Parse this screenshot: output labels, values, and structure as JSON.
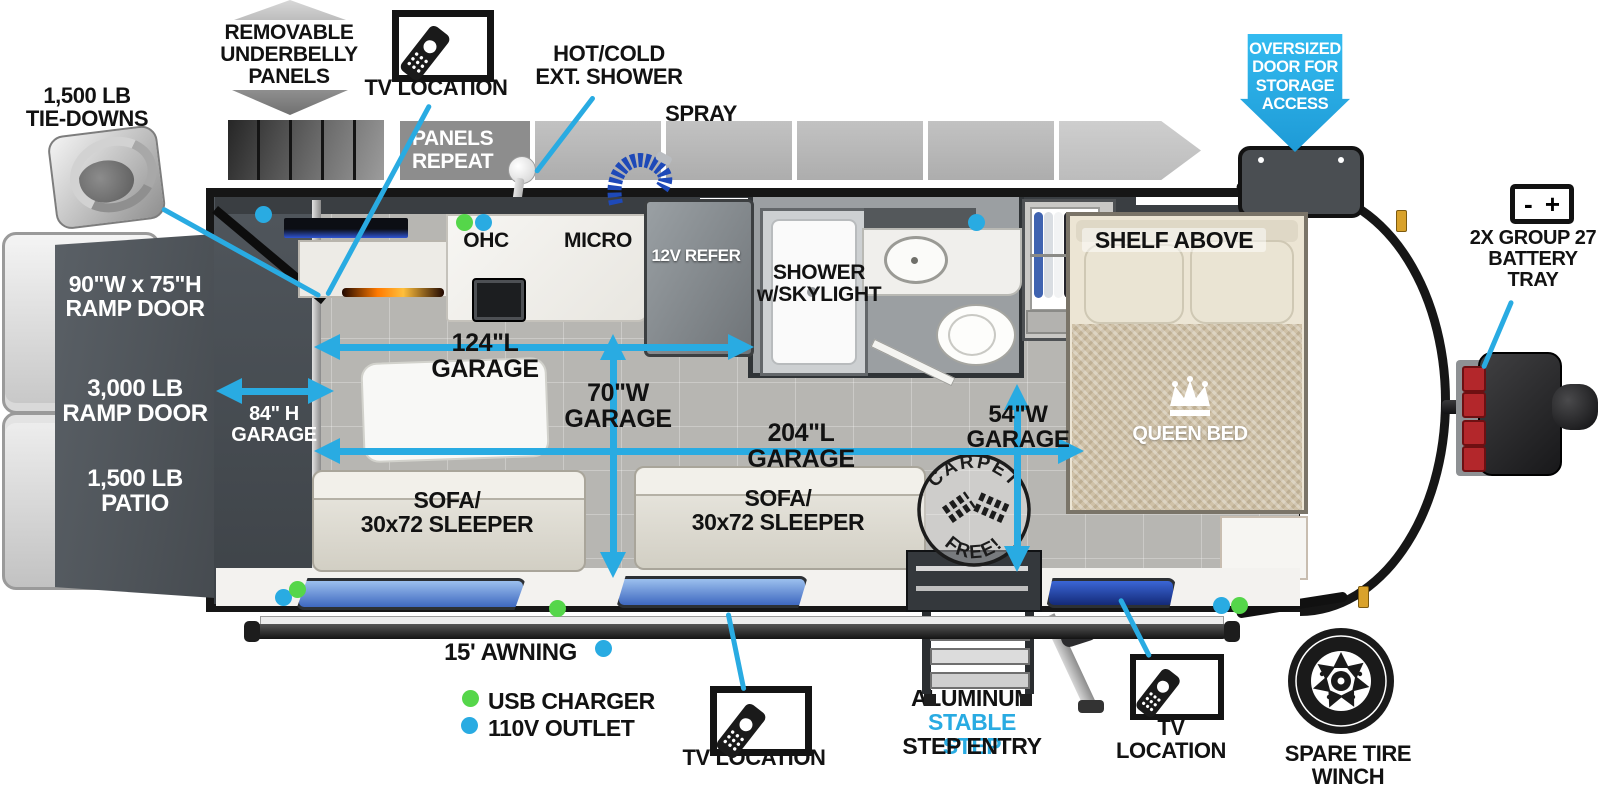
{
  "colors": {
    "accent_blue": "#29abe2",
    "usb_green": "#55d64a",
    "outlet_blue": "#29abe2",
    "panel_gray": "#8d8d8d"
  },
  "callouts": {
    "tie_downs": "1,500 LB\nTIE-DOWNS",
    "underbelly": "REMOVABLE\nUNDERBELLY\nPANELS",
    "tv_top": "TV LOCATION",
    "ext_shower": "HOT/COLD\nEXT. SHOWER",
    "spray_port": "SPRAY\nPORT",
    "panels_repeat": "PANELS\nREPEAT",
    "oversized_door": "OVERSIZED\nDOOR FOR\nSTORAGE\nACCESS",
    "battery_tray": "2X GROUP 27\nBATTERY\nTRAY",
    "battery_minus": "-",
    "battery_plus": "+",
    "awning": "15' AWNING",
    "tv_bottom": "TV LOCATION",
    "step_entry_1": "ALUMINUM",
    "step_entry_2": "STABLE STEP",
    "step_entry_3": "STEP ENTRY",
    "tv_front": "TV LOCATION",
    "spare_tire": "SPARE TIRE\nWINCH SYSTEM"
  },
  "legend": {
    "usb": "USB CHARGER",
    "outlet": "110V OUTLET"
  },
  "ramp": {
    "size": "90\"W x 75\"H\nRAMP DOOR",
    "capacity": "3,000 LB\nRAMP DOOR",
    "patio": "1,500 LB\nPATIO"
  },
  "garage": {
    "height_84": "84\" H\nGARAGE",
    "length_124": "124\"L\nGARAGE",
    "width_70": "70\"W\nGARAGE",
    "length_204": "204\"L\nGARAGE",
    "width_54": "54\"W\nGARAGE"
  },
  "features": {
    "ohc": "OHC",
    "micro": "MICRO",
    "refer": "12V REFER",
    "shower": "SHOWER\nw/SKYLIGHT",
    "shelf": "SHELF ABOVE",
    "queen_bed": "QUEEN BED",
    "sofa": "SOFA/\n30x72 SLEEPER",
    "carpet_top": "CARPET",
    "carpet_bottom": "FREE!"
  }
}
